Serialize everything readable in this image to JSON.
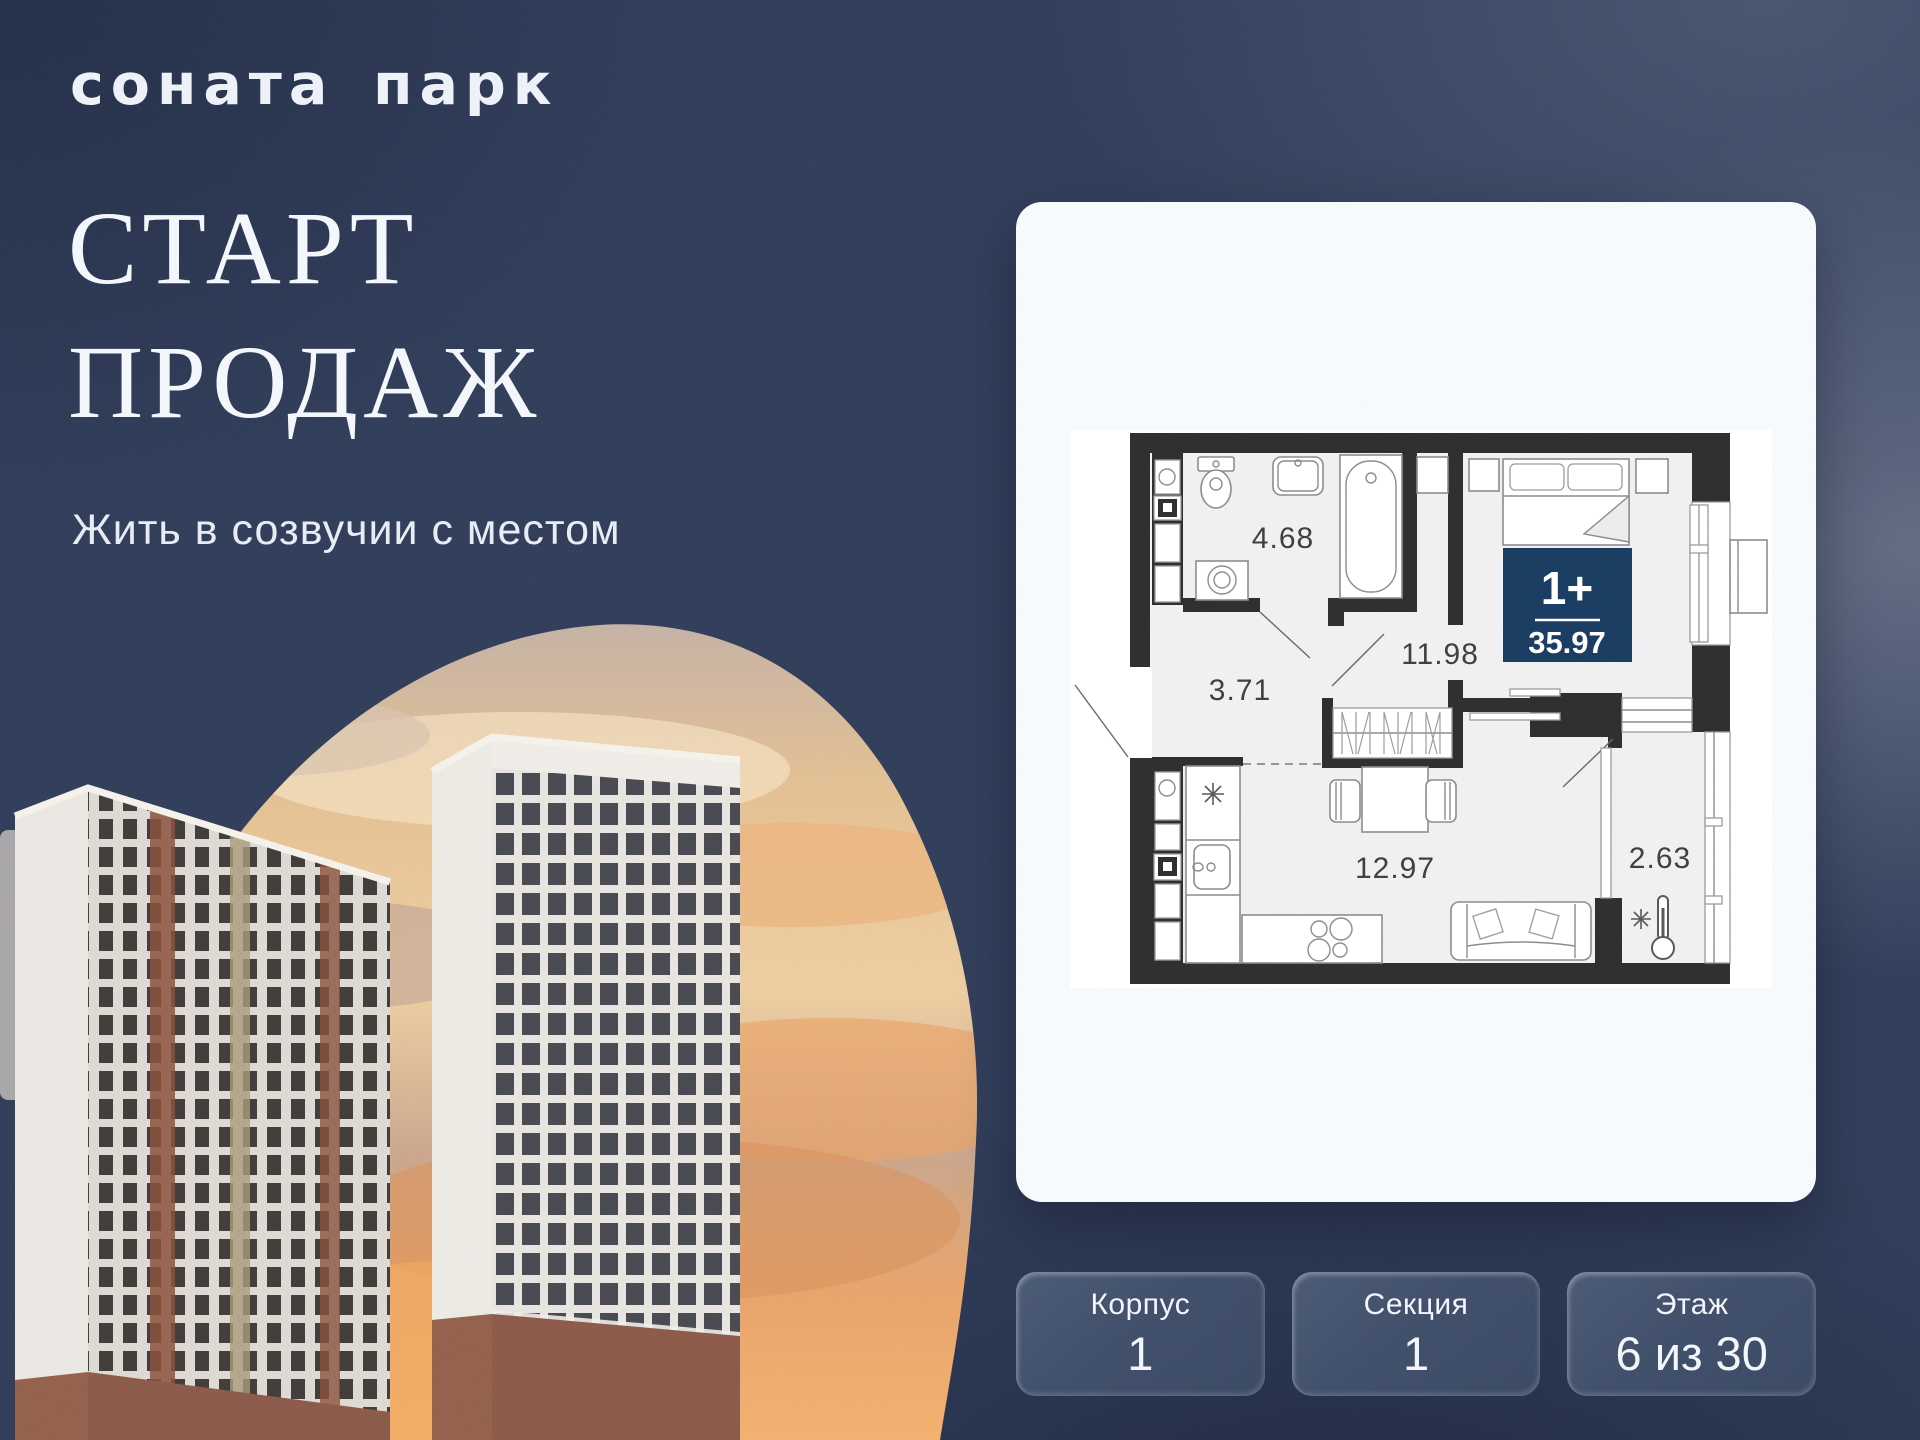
{
  "brand": {
    "logo": "соната парк"
  },
  "hero": {
    "title_line1": "СТАРТ",
    "title_line2": "ПРОДАЖ",
    "subtitle": "Жить в созвучии с местом"
  },
  "apartment": {
    "badge": {
      "rooms": "1+",
      "total_area": "35.97"
    },
    "room_areas": {
      "bathroom": "4.68",
      "hallway": "3.71",
      "bedroom": "11.98",
      "kitchen_living": "12.97",
      "balcony": "2.63"
    }
  },
  "details": {
    "boxes": [
      {
        "label": "Корпус",
        "value": "1"
      },
      {
        "label": "Секция",
        "value": "1"
      },
      {
        "label": "Этаж",
        "value": "6 из 30"
      }
    ]
  },
  "colors": {
    "background": "#2e3b58",
    "card_bg": "#f7fafd",
    "badge_bg": "#16395f",
    "walls": "#2b2b2b",
    "info_box": "#3d4c68",
    "sunset_top": "#c4b1a4",
    "sunset_bottom": "#f2b06e"
  }
}
